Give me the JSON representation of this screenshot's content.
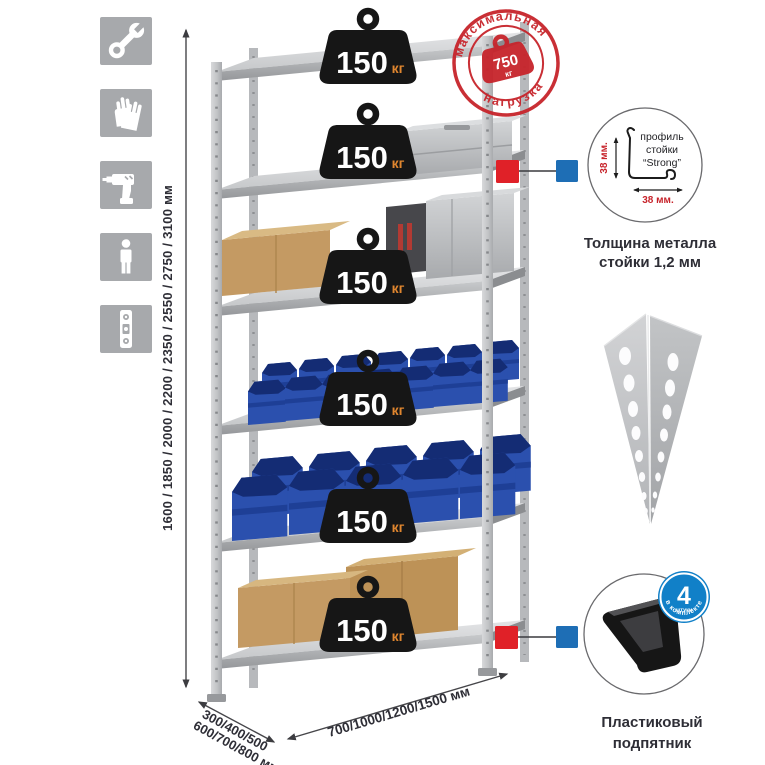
{
  "sidebar": {
    "tile_color": "#a7a9ac",
    "icons": [
      {
        "name": "wrench"
      },
      {
        "name": "gloves"
      },
      {
        "name": "drill"
      },
      {
        "name": "person"
      },
      {
        "name": "spirit-level"
      }
    ]
  },
  "rack": {
    "max_load_stamp": {
      "arc_top": "максимальная",
      "arc_bottom": "нагрузка",
      "value": "750",
      "unit": "кг"
    },
    "shelf_loads": [
      {
        "value": "150",
        "unit": "кг"
      },
      {
        "value": "150",
        "unit": "кг"
      },
      {
        "value": "150",
        "unit": "кг"
      },
      {
        "value": "150",
        "unit": "кг"
      },
      {
        "value": "150",
        "unit": "кг"
      },
      {
        "value": "150",
        "unit": "кг"
      }
    ],
    "height_options": "1600 / 1850 / 2000 / 2200 / 2350 / 2550 / 2750 / 3100 мм",
    "depth_options": {
      "line1": "300/400/500",
      "line2": "600/700/800 мм"
    },
    "width_options": "700/1000/1200/1500 мм"
  },
  "details": {
    "post_profile": {
      "sketch_label": {
        "line1": "профиль",
        "line2": "стойки",
        "line3": "“Strong”"
      },
      "height_dim": "38 мм.",
      "width_dim": "38 мм.",
      "caption": {
        "line1": "Толщина металла",
        "line2": "стойки 1,2 мм"
      }
    },
    "foot": {
      "badge": {
        "value": "4",
        "sub": "штуки",
        "arc": "в комплекте"
      },
      "caption": {
        "line1": "Пластиковый",
        "line2": "подпятник"
      }
    }
  },
  "colors": {
    "stamp_red": "#c7242b",
    "marker_red": "#e02128",
    "marker_blue": "#1e6eb5",
    "badge_blue": "#1180c8",
    "weight_black": "#161616",
    "kg_orange": "#e0862f",
    "bin_blue": "#2b50ae",
    "metal_gray": "#c9cbcd",
    "text_dark": "#2e2e36"
  }
}
